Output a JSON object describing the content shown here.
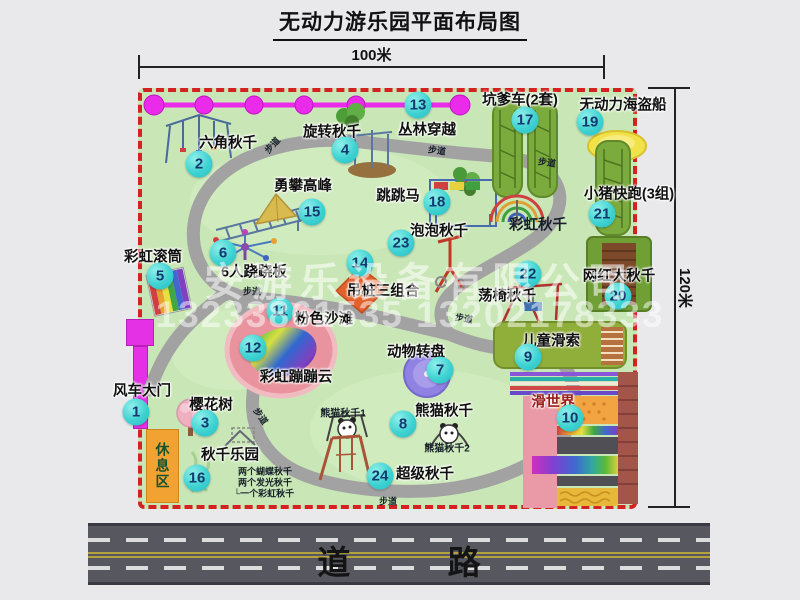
{
  "title": "无动力游乐园平面布局图",
  "dimensions": {
    "top": "100米",
    "right": "120米"
  },
  "road": {
    "label": "道 路"
  },
  "rest_area": {
    "label": "休息区"
  },
  "watermark": {
    "company": "安游乐设备有限公司",
    "phone": "13233861535 13202178333"
  },
  "park": {
    "attractions": [
      {
        "num": "1",
        "label": "风车大门",
        "bx": 136,
        "by": 412,
        "lx": 142,
        "ly": 390
      },
      {
        "num": "2",
        "label": "六角秋千",
        "bx": 199,
        "by": 164,
        "lx": 228,
        "ly": 142
      },
      {
        "num": "3",
        "label": "樱花树",
        "bx": 205,
        "by": 423,
        "lx": 211,
        "ly": 404
      },
      {
        "num": "4",
        "label": "旋转秋千",
        "bx": 345,
        "by": 150,
        "lx": 332,
        "ly": 131
      },
      {
        "num": "5",
        "label": "彩虹滚筒",
        "bx": 160,
        "by": 276,
        "lx": 153,
        "ly": 256
      },
      {
        "num": "6",
        "label": "6人跷跷板",
        "bx": 223,
        "by": 253,
        "lx": 254,
        "ly": 271
      },
      {
        "num": "7",
        "label": "动物转盘",
        "bx": 440,
        "by": 370,
        "lx": 416,
        "ly": 351
      },
      {
        "num": "8",
        "label": "熊猫秋千",
        "bx": 403,
        "by": 424,
        "lx": 444,
        "ly": 410
      },
      {
        "num": "9",
        "label": "儿童滑索",
        "bx": 528,
        "by": 357,
        "lx": 551,
        "ly": 340
      },
      {
        "num": "10",
        "label": "滑世界",
        "bx": 570,
        "by": 418,
        "lx": 553,
        "ly": 401,
        "color": "#9b1b1b"
      },
      {
        "num": "11",
        "label": "粉色沙滩",
        "bx": 280,
        "by": 311,
        "lx": 324,
        "ly": 318
      },
      {
        "num": "12",
        "label": "彩虹蹦蹦云",
        "bx": 253,
        "by": 348,
        "lx": 296,
        "ly": 376
      },
      {
        "num": "13",
        "label": "丛林穿越",
        "bx": 418,
        "by": 105,
        "lx": 427,
        "ly": 129
      },
      {
        "num": "14",
        "label": "吊桩三组合",
        "bx": 360,
        "by": 263,
        "lx": 383,
        "ly": 290
      },
      {
        "num": "15",
        "label": "勇攀高峰",
        "bx": 312,
        "by": 212,
        "lx": 303,
        "ly": 185
      },
      {
        "num": "16",
        "label": "秋千乐园",
        "bx": 197,
        "by": 478,
        "lx": 230,
        "ly": 454
      },
      {
        "num": "17",
        "label": "坑爹车(2套)",
        "bx": 525,
        "by": 120,
        "lx": 520,
        "ly": 99
      },
      {
        "num": "18",
        "label": "跳跳马",
        "bx": 437,
        "by": 202,
        "lx": 398,
        "ly": 195
      },
      {
        "num": "19",
        "label": "无动力海盗船",
        "bx": 590,
        "by": 122,
        "lx": 623,
        "ly": 104
      },
      {
        "num": "20",
        "label": "网红大秋千",
        "bx": 618,
        "by": 296,
        "lx": 619,
        "ly": 275
      },
      {
        "num": "21",
        "label": "小猪快跑(3组)",
        "bx": 602,
        "by": 214,
        "lx": 629,
        "ly": 193
      },
      {
        "num": "22",
        "label": "荡椅秋千",
        "bx": 528,
        "by": 274,
        "lx": 507,
        "ly": 295
      },
      {
        "num": "23",
        "label": "泡泡秋千",
        "bx": 401,
        "by": 243,
        "lx": 439,
        "ly": 230
      },
      {
        "num": "24",
        "label": "超级秋千",
        "bx": 380,
        "by": 476,
        "lx": 425,
        "ly": 473
      }
    ],
    "annotations": [
      {
        "text": "彩虹秋千",
        "x": 538,
        "y": 224,
        "size": 14.5,
        "bold": true
      },
      {
        "text": "熊猫秋千1",
        "x": 343,
        "y": 412,
        "size": 10,
        "bold": true
      },
      {
        "text": "熊猫秋千2",
        "x": 447,
        "y": 447,
        "size": 10,
        "bold": true
      },
      {
        "text": "两个蝴蝶秋千",
        "x": 265,
        "y": 471,
        "size": 9,
        "bold": true
      },
      {
        "text": "两个发光秋千",
        "x": 265,
        "y": 482,
        "size": 9,
        "bold": true
      },
      {
        "text": "└一个彩虹秋千",
        "x": 264,
        "y": 493,
        "size": 9,
        "bold": true
      },
      {
        "text": "步道",
        "x": 272,
        "y": 145,
        "size": 9,
        "rot": -48,
        "bold": true
      },
      {
        "text": "步道",
        "x": 437,
        "y": 150,
        "size": 9,
        "rot": 8,
        "bold": true
      },
      {
        "text": "步道",
        "x": 547,
        "y": 162,
        "size": 9,
        "rot": 8,
        "bold": true
      },
      {
        "text": "步道",
        "x": 252,
        "y": 291,
        "size": 9,
        "rot": 0,
        "bold": true
      },
      {
        "text": "步道",
        "x": 261,
        "y": 416,
        "size": 9,
        "rot": 55,
        "bold": true
      },
      {
        "text": "步道",
        "x": 464,
        "y": 318,
        "size": 9,
        "rot": 10,
        "bold": true
      },
      {
        "text": "步道",
        "x": 388,
        "y": 501,
        "size": 9,
        "rot": 0,
        "bold": true
      }
    ]
  }
}
